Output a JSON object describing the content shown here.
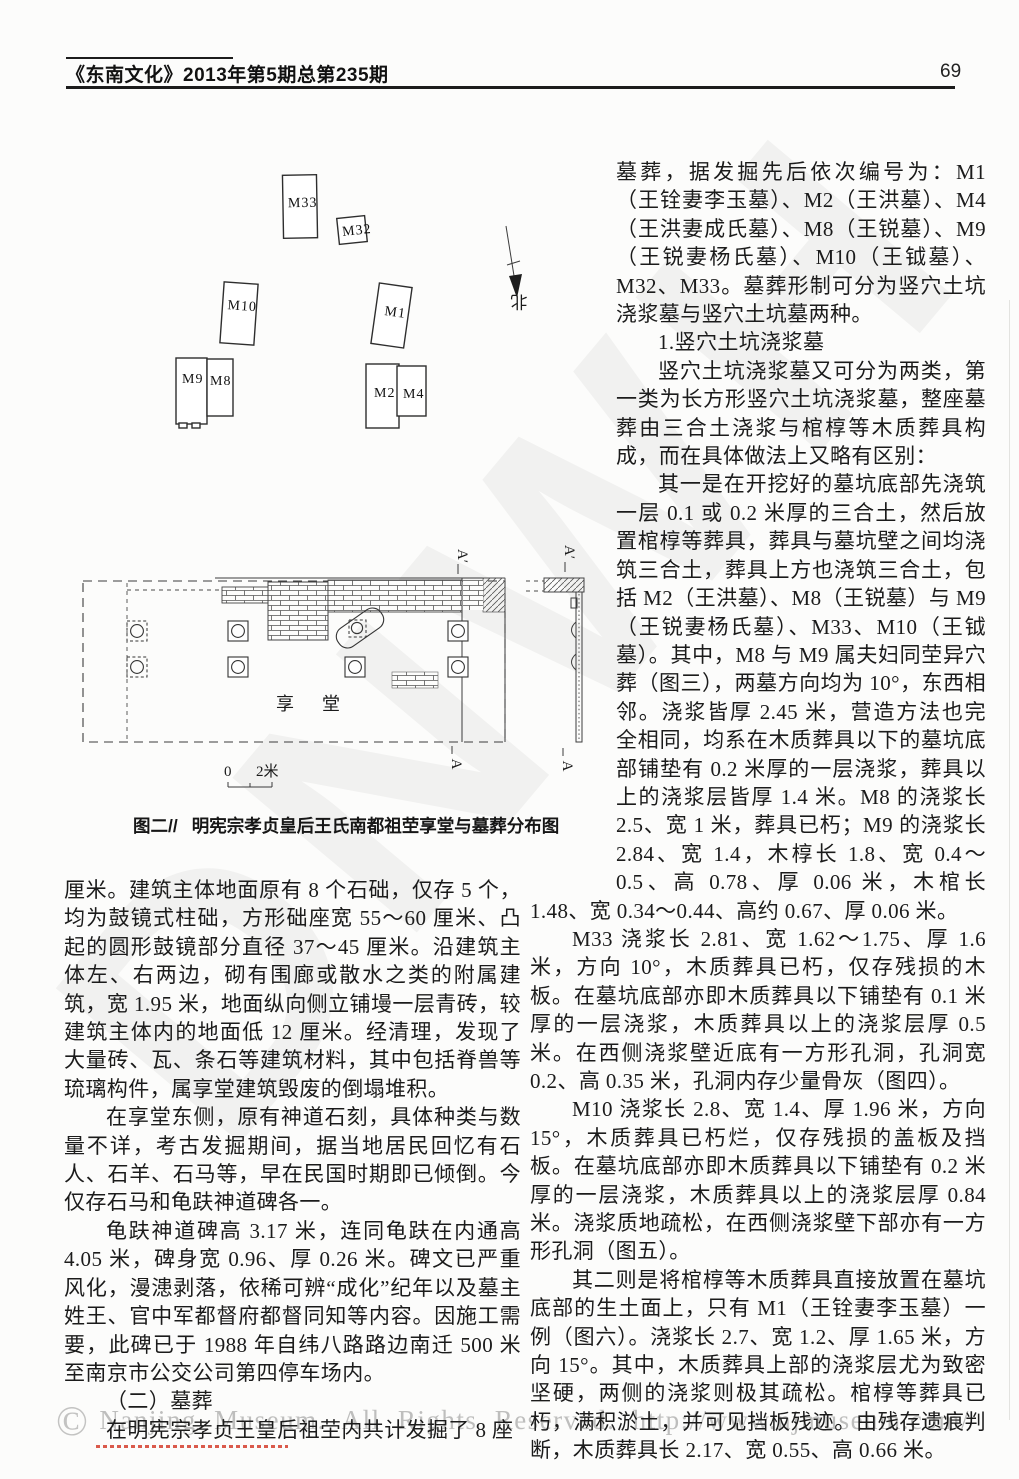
{
  "header": {
    "journal_issue": "《东南文化》2013年第5期总第235期",
    "page_number": "69"
  },
  "figure": {
    "caption": {
      "prefix": "图二//",
      "title": "明宪宗孝贞皇后王氏南都祖茔享堂与墓葬分布图"
    },
    "map": {
      "north_label": "北",
      "hall_label": "享堂",
      "scale": {
        "zero": "0",
        "two_m": "2米"
      },
      "section_labels": {
        "plan_top": "A′",
        "plan_bottom": "A",
        "section_top": "A′",
        "section_bottom": "A"
      },
      "tombs": [
        {
          "id": "M33",
          "x": 223,
          "y": 25,
          "w": 34,
          "h": 63,
          "rot": -1,
          "lx": 5,
          "ly": 32,
          "feet": false
        },
        {
          "id": "M32",
          "x": 278,
          "y": 67,
          "w": 28,
          "h": 26,
          "rot": -6,
          "lx": 4,
          "ly": 18,
          "feet": false
        },
        {
          "id": "M10",
          "x": 162,
          "y": 133,
          "w": 34,
          "h": 61,
          "rot": 4,
          "lx": 5,
          "ly": 27,
          "feet": false
        },
        {
          "id": "M1",
          "x": 315,
          "y": 135,
          "w": 33,
          "h": 61,
          "rot": 8,
          "lx": 9,
          "ly": 31,
          "feet": false
        },
        {
          "id": "M9",
          "x": 116,
          "y": 208,
          "w": 31,
          "h": 66,
          "rot": 0,
          "lx": 6,
          "ly": 25,
          "feet": true
        },
        {
          "id": "M8",
          "x": 147,
          "y": 209,
          "w": 26,
          "h": 57,
          "rot": 0,
          "lx": 3,
          "ly": 26,
          "feet": false
        },
        {
          "id": "M2",
          "x": 306,
          "y": 214,
          "w": 33,
          "h": 64,
          "rot": 0,
          "lx": 8,
          "ly": 33,
          "feet": false
        },
        {
          "id": "M4",
          "x": 337,
          "y": 216,
          "w": 29,
          "h": 50,
          "rot": 0,
          "lx": 6,
          "ly": 32,
          "feet": false
        }
      ]
    }
  },
  "left_column": {
    "paragraphs": [
      {
        "indent": false,
        "text": "厘米。建筑主体地面原有 8 个石础，仅存 5 个，均为鼓镜式柱础，方形础座宽 55～60 厘米、凸起的圆形鼓镜部分直径 37～45 厘米。沿建筑主体左、右两边，砌有围廊或散水之类的附属建筑，宽 1.95 米，地面纵向侧立铺墁一层青砖，较建筑主体内的地面低 12 厘米。经清理，发现了大量砖、瓦、条石等建筑材料，其中包括脊兽等琉璃构件，属享堂建筑毁废的倒塌堆积。"
      },
      {
        "indent": true,
        "text": "在享堂东侧，原有神道石刻，具体种类与数量不详，考古发掘期间，据当地居民回忆有石人、石羊、石马等，早在民国时期即已倾倒。今仅存石马和龟趺神道碑各一。"
      },
      {
        "indent": true,
        "text": "龟趺神道碑高 3.17 米，连同龟趺在内通高 4.05 米，碑身宽 0.96、厚 0.26 米。碑文已严重风化，漫漶剥落，依稀可辨“成化”纪年以及墓主姓王、官中军都督府都督同知等内容。因施工需要，此碑已于 1988 年自纬八路路边南迁 500 米至南京市公交公司第四停车场内。"
      },
      {
        "indent": true,
        "text": "（二）墓葬"
      },
      {
        "indent": true,
        "text": "在明宪宗孝贞王皇后祖茔内共计发掘了 8 座"
      }
    ]
  },
  "right_column": {
    "paragraphs": [
      {
        "indent": false,
        "text": "墓葬，据发掘先后依次编号为：M1（王铨妻李玉墓）、M2（王洪墓）、M4（王洪妻成氏墓）、M8（王锐墓）、M9（王锐妻杨氏墓）、M10（王钺墓）、M32、M33。墓葬形制可分为竖穴土坑浇浆墓与竖穴土坑墓两种。"
      },
      {
        "indent": true,
        "text": "1.竖穴土坑浇浆墓"
      },
      {
        "indent": true,
        "text": "竖穴土坑浇浆墓又可分为两类，第一类为长方形竖穴土坑浇浆墓，整座墓葬由三合土浇浆与棺椁等木质葬具构成，而在具体做法上又略有区别："
      },
      {
        "indent": true,
        "text": "其一是在开挖好的墓坑底部先浇筑一层 0.1 或 0.2 米厚的三合土，然后放置棺椁等葬具，葬具与墓坑壁之间均浇筑三合土，葬具上方也浇筑三合土，包括 M2（王洪墓）、M8（王锐墓）与 M9（王锐妻杨氏墓）、M33、M10（王钺墓）。其中，M8 与 M9 属夫妇同茔异穴葬（图三），两墓方向均为 10°，东西相邻。浇浆皆厚 2.45 米，营造方法也完全相同，均系在木质葬具以下的墓坑底部铺垫有 0.2 米厚的一层浇浆，葬具以上的浇浆层皆厚 1.4 米。M8 的浇浆长 2.5、宽 1 米，葬具已朽；M9 的浇浆长 2.84、宽 1.4，木椁长 1.8、宽 0.4～0.5、高 0.78、厚 0.06 米，木棺长 1.48、宽 0.34～0.44、高约 0.67、厚 0.06 米。"
      },
      {
        "indent": true,
        "text": "M33 浇浆长 2.81、宽 1.62～1.75、厚 1.6 米，方向 10°，木质葬具已朽，仅存残损的木板。在墓坑底部亦即木质葬具以下铺垫有 0.1 米厚的一层浇浆，木质葬具以上的浇浆层厚 0.5 米。在西侧浇浆壁近底有一方形孔洞，孔洞宽 0.2、高 0.35 米，孔洞内存少量骨灰（图四）。"
      },
      {
        "indent": true,
        "text": "M10 浇浆长 2.8、宽 1.4、厚 1.96 米，方向 15°，木质葬具已朽烂，仅存残损的盖板及挡板。在墓坑底部亦即木质葬具以下铺垫有 0.2 米厚的一层浇浆，木质葬具以上的浇浆层厚 0.84 米。浇浆质地疏松，在西侧浇浆壁下部亦有一方形孔洞（图五）。"
      },
      {
        "indent": true,
        "text": "其二则是将棺椁等木质葬具直接放置在墓坑底部的生土面上，只有 M1（王铨妻李玉墓）一例（图六）。浇浆长 2.7、宽 1.2、厚 1.65 米，方向 15°。其中，木质葬具上部的浇浆层尤为致密坚硬，两侧的浇浆则极其疏松。棺椁等葬具已朽，满积淤土，并可见挡板残迹。由残存遗痕判断，木质葬具长 2.17、宽 0.55、高 0.66 米。"
      }
    ]
  },
  "watermark": {
    "diagonal_text": "DNWH",
    "copyright_symbol": "©",
    "bottom_text": "Nanjing Museum. All Rights Reserved. http://www.njmuseum.com/"
  }
}
